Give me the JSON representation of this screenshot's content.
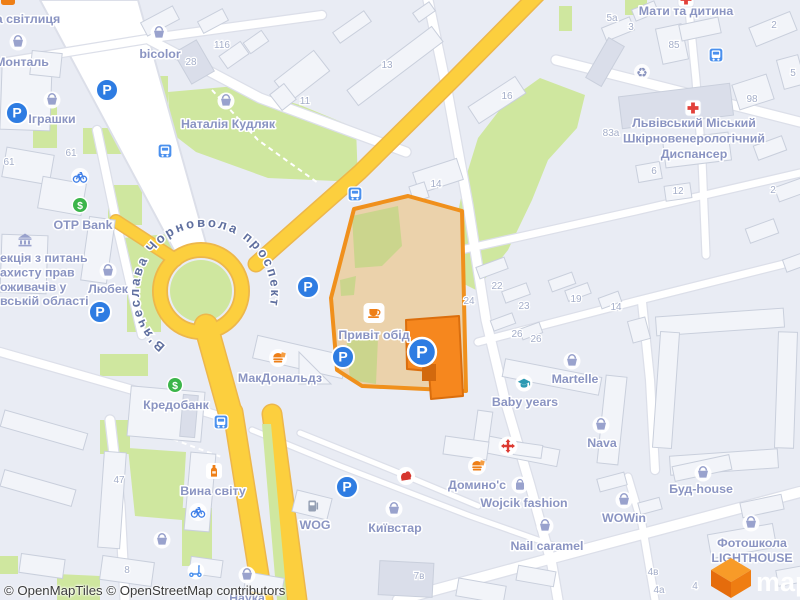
{
  "attribution": "© OpenMapTiles © OpenStreetMap contributors",
  "street": "В'ячеслава Чорновола проспект",
  "logo_text": "maptiler",
  "colors": {
    "land": "#e9ecf4",
    "park": "#cfe79f",
    "parkInHighlight": "#cbd58d",
    "road": "#ffffff",
    "roadCasing": "#dcdfe9",
    "yellowRoad": "#fccf3e",
    "yellowCasing": "#edb74b",
    "building": "#f2f4f9",
    "buildingEdge": "#c9cfdc",
    "buildingDark": "#dadeea",
    "highlightFill": "#ebd2ab",
    "highlightStroke": "#f0901c",
    "selectedBuilding": "#f6871e",
    "selectedBuildingEdge": "#db6e0d",
    "poiLabel": "#8a94c2",
    "streetLabel": "#5f6f9f",
    "housenumber": "#a4aec9",
    "parkingBlue": "#2e7ce2",
    "busBlue": "#4a90ee",
    "bankGreen": "#3cb54a",
    "basketPurple": "#99a2cd",
    "medicalRed": "#e2403a",
    "accentOrange": "#ee7f17",
    "tealCap": "#2d9ab3",
    "attributionColor": "#3c3c3c"
  },
  "pois": [
    {
      "t": "а світлиця",
      "x": 28,
      "y": 23
    },
    {
      "t": "Монталь",
      "x": 22,
      "y": 66,
      "icon": "basket",
      "ix": 18,
      "iy": 42
    },
    {
      "t": "bicolor",
      "x": 160,
      "y": 58,
      "icon": "basket",
      "ix": 159,
      "iy": 33
    },
    {
      "t": "Іграшки",
      "x": 52,
      "y": 123,
      "icon": "basket",
      "ix": 52,
      "iy": 100
    },
    {
      "t": "Наталія Кудляк",
      "x": 228,
      "y": 128,
      "icon": "basket",
      "ix": 226,
      "iy": 101
    },
    {
      "t": "Мати та дитина",
      "x": 686,
      "y": 15,
      "icon": "medical",
      "ix": 686,
      "iy": -1
    },
    {
      "lines": [
        "Львівський Міський",
        "Шкірновенерологічний",
        "Диспансер"
      ],
      "x": 694,
      "y": 127,
      "lh": 15.5,
      "icon": "medical",
      "ix": 693,
      "iy": 108
    },
    {
      "t": "OTP Bank",
      "x": 83,
      "y": 229,
      "icon": "atm",
      "ix": 80,
      "iy": 205
    },
    {
      "lines": [
        "екція з питань",
        "ахисту прав",
        "оживачів у",
        "вській області"
      ],
      "x": 0,
      "y": 262,
      "lh": 14.4,
      "anchor": "start",
      "icon": "museum",
      "ix": 25,
      "iy": 240
    },
    {
      "t": "Любек",
      "x": 108,
      "y": 293,
      "icon": "basket",
      "ix": 108,
      "iy": 271
    },
    {
      "t": "МакДональдз",
      "x": 280,
      "y": 382,
      "icon": "burger",
      "ix": 278,
      "iy": 358
    },
    {
      "t": "Привіт обід",
      "x": 374,
      "y": 339,
      "icon": "cafe",
      "ix": 374,
      "iy": 313
    },
    {
      "t": "Кредобанк",
      "x": 176,
      "y": 409,
      "icon": "atm",
      "ix": 175,
      "iy": 385
    },
    {
      "t": "Вина світу",
      "x": 213,
      "y": 495,
      "icon": "bottle",
      "ix": 214,
      "iy": 471
    },
    {
      "t": "WOG",
      "x": 315,
      "y": 529,
      "icon": "fuel",
      "ix": 313,
      "iy": 506
    },
    {
      "t": "Київстар",
      "x": 395,
      "y": 532,
      "icon": "basket",
      "ix": 394,
      "iy": 509
    },
    {
      "t": "Домино'c",
      "x": 477,
      "y": 489,
      "icon": "burger",
      "ix": 477,
      "iy": 466
    },
    {
      "t": "Wojcik fashion",
      "x": 524,
      "y": 507,
      "icon": "bag",
      "ix": 520,
      "iy": 485
    },
    {
      "t": "WOWin",
      "x": 624,
      "y": 522,
      "icon": "basket",
      "ix": 624,
      "iy": 500
    },
    {
      "t": "Nail caramel",
      "x": 547,
      "y": 550,
      "icon": "basket",
      "ix": 545,
      "iy": 526
    },
    {
      "t": "Baby years",
      "x": 525,
      "y": 406,
      "icon": "gradcap",
      "ix": 524,
      "iy": 383
    },
    {
      "t": "Martelle",
      "x": 575,
      "y": 383,
      "icon": "basket",
      "ix": 572,
      "iy": 361
    },
    {
      "t": "Nava",
      "x": 602,
      "y": 447,
      "icon": "basket",
      "ix": 601,
      "iy": 425
    },
    {
      "t": "Буд-house",
      "x": 701,
      "y": 493,
      "icon": "basket",
      "ix": 703,
      "iy": 473
    },
    {
      "lines": [
        "Фотошкола",
        "LIGHTHOUSE"
      ],
      "x": 752,
      "y": 547,
      "lh": 15,
      "icon": "basket",
      "ix": 751,
      "iy": 523
    },
    {
      "t": "Наука",
      "x": 247,
      "y": 602
    }
  ],
  "housenumbers": [
    {
      "t": "61",
      "x": 9,
      "y": 165
    },
    {
      "t": "61",
      "x": 71,
      "y": 156
    },
    {
      "t": "116",
      "x": 222,
      "y": 48
    },
    {
      "t": "28",
      "x": 191,
      "y": 65
    },
    {
      "t": "11",
      "x": 305,
      "y": 104
    },
    {
      "t": "13",
      "x": 387,
      "y": 68
    },
    {
      "t": "16",
      "x": 507,
      "y": 99
    },
    {
      "t": "14",
      "x": 436,
      "y": 187
    },
    {
      "t": "5а",
      "x": 612,
      "y": 21
    },
    {
      "t": "3",
      "x": 631,
      "y": 30
    },
    {
      "t": "85",
      "x": 674,
      "y": 48
    },
    {
      "t": "2",
      "x": 774,
      "y": 28
    },
    {
      "t": "5",
      "x": 793,
      "y": 76
    },
    {
      "t": "98",
      "x": 752,
      "y": 102
    },
    {
      "t": "83а",
      "x": 611,
      "y": 136
    },
    {
      "t": "6",
      "x": 654,
      "y": 174
    },
    {
      "t": "12",
      "x": 678,
      "y": 194
    },
    {
      "t": "2",
      "x": 773,
      "y": 193
    },
    {
      "t": "22",
      "x": 497,
      "y": 289
    },
    {
      "t": "24",
      "x": 469,
      "y": 304
    },
    {
      "t": "23",
      "x": 524,
      "y": 309
    },
    {
      "t": "19",
      "x": 576,
      "y": 302
    },
    {
      "t": "26",
      "x": 517,
      "y": 337
    },
    {
      "t": "26",
      "x": 536,
      "y": 342
    },
    {
      "t": "14",
      "x": 616,
      "y": 310
    },
    {
      "t": "47",
      "x": 119,
      "y": 483
    },
    {
      "t": "8",
      "x": 127,
      "y": 573
    },
    {
      "t": "7в",
      "x": 419,
      "y": 579
    },
    {
      "t": "4в",
      "x": 653,
      "y": 575
    },
    {
      "t": "4а",
      "x": 659,
      "y": 593
    },
    {
      "t": "4",
      "x": 695,
      "y": 589
    }
  ],
  "icons": [
    {
      "type": "parking",
      "x": 17,
      "y": 113
    },
    {
      "type": "parking",
      "x": 107,
      "y": 90
    },
    {
      "type": "parking",
      "x": 100,
      "y": 312
    },
    {
      "type": "parking",
      "x": 308,
      "y": 287
    },
    {
      "type": "parking",
      "x": 343,
      "y": 357
    },
    {
      "type": "parking",
      "x": 347,
      "y": 487
    },
    {
      "type": "parking_lg",
      "x": 422,
      "y": 352
    },
    {
      "type": "bus",
      "x": 165,
      "y": 151
    },
    {
      "type": "bus",
      "x": 355,
      "y": 194
    },
    {
      "type": "bus",
      "x": 221,
      "y": 422
    },
    {
      "type": "bus",
      "x": 716,
      "y": 55
    },
    {
      "type": "arrows",
      "x": 508,
      "y": 446
    },
    {
      "type": "recycle",
      "x": 642,
      "y": 72
    },
    {
      "type": "bike",
      "x": 80,
      "y": 177
    },
    {
      "type": "bike",
      "x": 198,
      "y": 512
    },
    {
      "type": "scooter",
      "x": 196,
      "y": 571
    },
    {
      "type": "basket",
      "x": 162,
      "y": 540
    },
    {
      "type": "basket",
      "x": 247,
      "y": 575
    },
    {
      "type": "redemblem",
      "x": 406,
      "y": 476
    },
    {
      "type": "shopcut",
      "x": 8,
      "y": 1
    }
  ]
}
